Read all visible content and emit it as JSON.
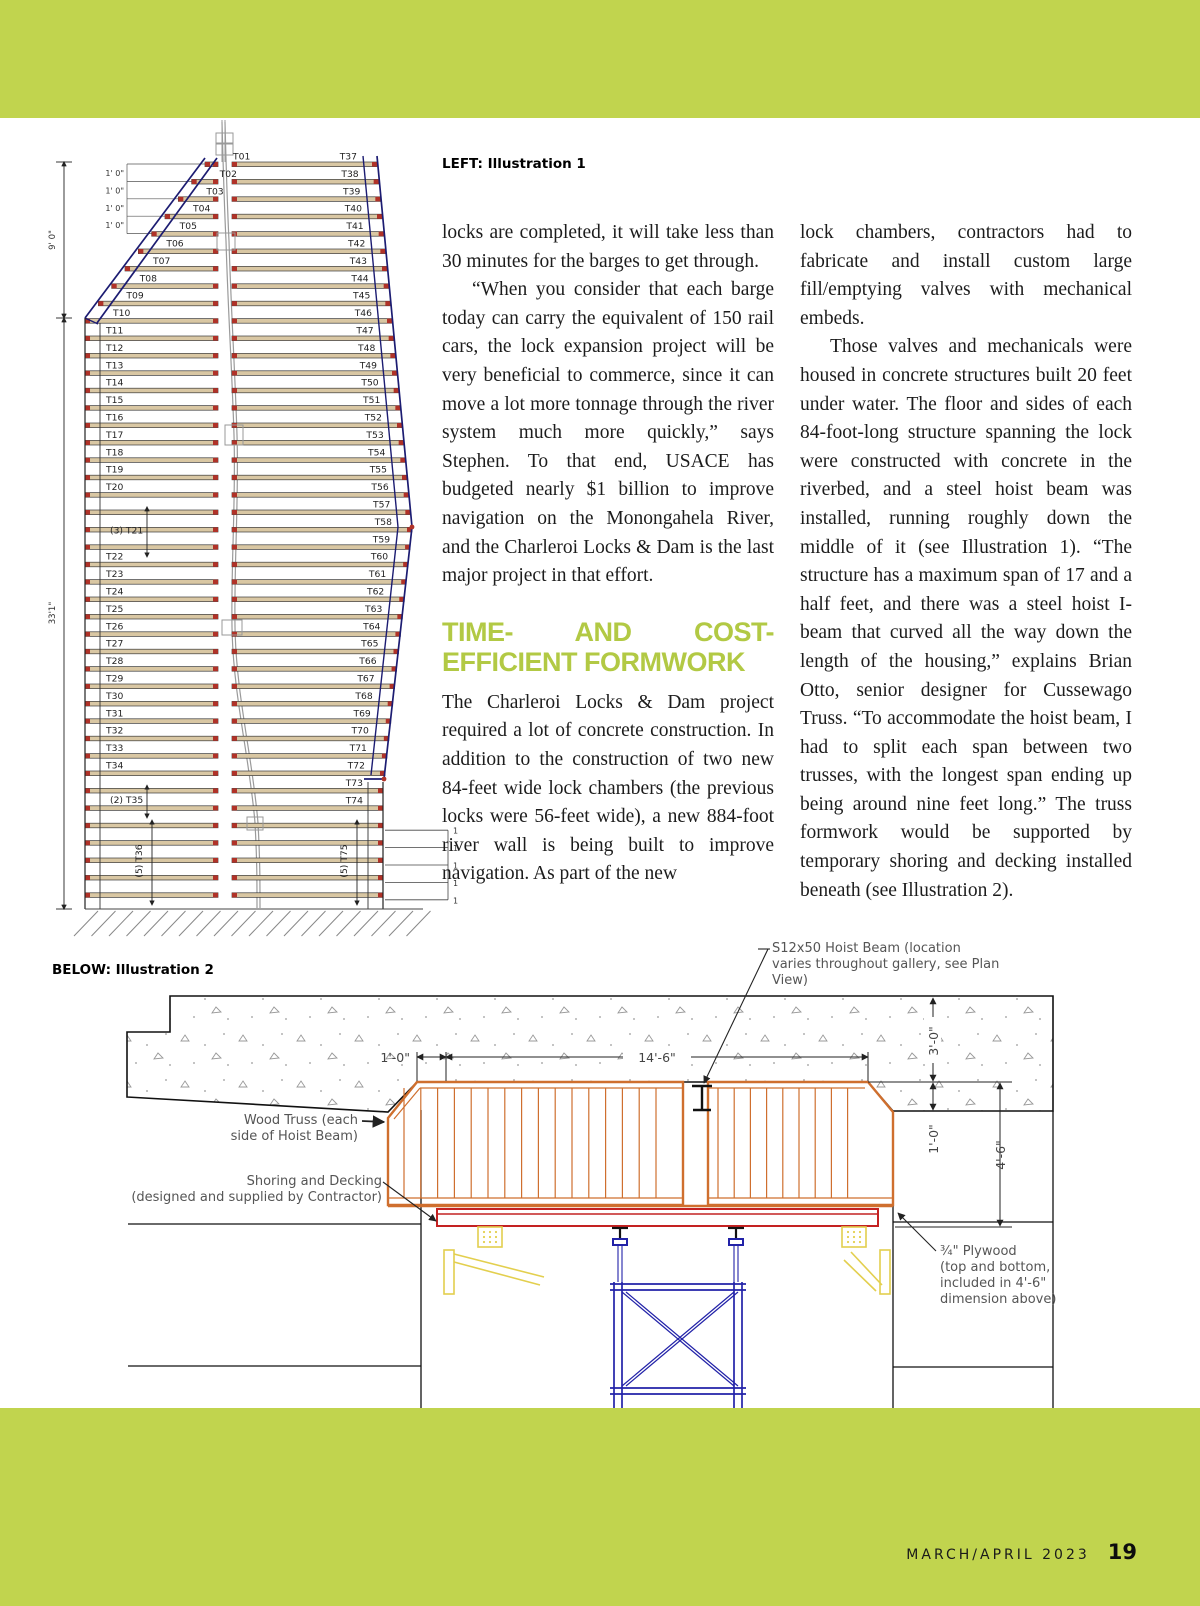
{
  "page": {
    "captions": {
      "illustration1": "LEFT: Illustration 1",
      "illustration2": "BELOW: Illustration 2"
    },
    "footer": {
      "issue": "MARCH/APRIL 2023",
      "page_number": "19"
    }
  },
  "article": {
    "col1": {
      "para1": "locks are completed, it will take less than 30 minutes for the barges to get through.",
      "para2": "“When you consider that each barge today can carry the equivalent of 150 rail cars, the lock expansion project will be very beneficial to commerce, since it can move a lot more tonnage through the river system much more quickly,” says Stephen. To that end, USACE has budgeted nearly $1 billion to improve navigation on the Monongahela River, and the Charleroi Locks & Dam is the last major project in that effort.",
      "heading": "TIME- AND COST-EFFICIENT FORMWORK",
      "para3": "The Charleroi Locks & Dam project required a lot of concrete construction. In addition to the construction of two new 84-feet wide lock chambers (the previous locks were 56-feet wide), a new 884-foot river wall is being built to improve navigation. As part of the new"
    },
    "col2": {
      "para1": "lock chambers, contractors had to fabricate and install custom large fill/emptying valves with mechanical embeds.",
      "para2": "Those valves and mechanicals were housed in concrete structures built 20 feet under water. The floor and sides of each 84-foot-long structure spanning the lock were constructed with concrete in the riverbed, and a steel hoist beam was installed, running roughly down the middle of it (see Illustration 1). “The structure has a maximum span of 17 and a half feet, and there was a steel hoist I-beam that curved all the way down the length of the housing,” explains Brian Otto, senior designer for Cussewago Truss. “To accommodate the hoist beam, I had to split each span between two trusses, with the longest span ending up being around nine feet long.” The truss formwork would be supported by temporary shoring and decking installed beneath (see Illustration 2)."
    }
  },
  "illustration1": {
    "left_column": [
      {
        "label": "T01",
        "bars": 1
      },
      {
        "label": "T02",
        "bars": 1
      },
      {
        "label": "T03",
        "bars": 1
      },
      {
        "label": "T04",
        "bars": 1
      },
      {
        "label": "T05",
        "bars": 1
      },
      {
        "label": "T06",
        "bars": 1
      },
      {
        "label": "T07",
        "bars": 1
      },
      {
        "label": "T08",
        "bars": 1
      },
      {
        "label": "T09",
        "bars": 1
      },
      {
        "label": "T10",
        "bars": 1
      },
      {
        "label": "T11",
        "bars": 1
      },
      {
        "label": "T12",
        "bars": 1
      },
      {
        "label": "T13",
        "bars": 1
      },
      {
        "label": "T14",
        "bars": 1
      },
      {
        "label": "T15",
        "bars": 1
      },
      {
        "label": "T16",
        "bars": 1
      },
      {
        "label": "T17",
        "bars": 1
      },
      {
        "label": "T18",
        "bars": 1
      },
      {
        "label": "T19",
        "bars": 1
      },
      {
        "label": "T20",
        "bars": 1
      },
      {
        "label": "(3) T21",
        "bars": 3,
        "arrow": true
      },
      {
        "label": "T22",
        "bars": 1
      },
      {
        "label": "T23",
        "bars": 1
      },
      {
        "label": "T24",
        "bars": 1
      },
      {
        "label": "T25",
        "bars": 1
      },
      {
        "label": "T26",
        "bars": 1
      },
      {
        "label": "T27",
        "bars": 1
      },
      {
        "label": "T28",
        "bars": 1
      },
      {
        "label": "T29",
        "bars": 1
      },
      {
        "label": "T30",
        "bars": 1
      },
      {
        "label": "T31",
        "bars": 1
      },
      {
        "label": "T32",
        "bars": 1
      },
      {
        "label": "T33",
        "bars": 1
      },
      {
        "label": "T34",
        "bars": 1
      },
      {
        "label": "(2) T35",
        "bars": 2,
        "arrow": true
      },
      {
        "label": "(5) T36",
        "bars": 5,
        "rotated": true
      }
    ],
    "right_column": [
      {
        "label": "T37",
        "bars": 1
      },
      {
        "label": "T38",
        "bars": 1
      },
      {
        "label": "T39",
        "bars": 1
      },
      {
        "label": "T40",
        "bars": 1
      },
      {
        "label": "T41",
        "bars": 1
      },
      {
        "label": "T42",
        "bars": 1
      },
      {
        "label": "T43",
        "bars": 1
      },
      {
        "label": "T44",
        "bars": 1
      },
      {
        "label": "T45",
        "bars": 1
      },
      {
        "label": "T46",
        "bars": 1
      },
      {
        "label": "T47",
        "bars": 1
      },
      {
        "label": "T48",
        "bars": 1
      },
      {
        "label": "T49",
        "bars": 1
      },
      {
        "label": "T50",
        "bars": 1
      },
      {
        "label": "T51",
        "bars": 1
      },
      {
        "label": "T52",
        "bars": 1
      },
      {
        "label": "T53",
        "bars": 1
      },
      {
        "label": "T54",
        "bars": 1
      },
      {
        "label": "T55",
        "bars": 1
      },
      {
        "label": "T56",
        "bars": 1
      },
      {
        "label": "T57",
        "bars": 1
      },
      {
        "label": "T58",
        "bars": 1
      },
      {
        "label": "T59",
        "bars": 1
      },
      {
        "label": "T60",
        "bars": 1
      },
      {
        "label": "T61",
        "bars": 1
      },
      {
        "label": "T62",
        "bars": 1
      },
      {
        "label": "T63",
        "bars": 1
      },
      {
        "label": "T64",
        "bars": 1
      },
      {
        "label": "T65",
        "bars": 1
      },
      {
        "label": "T66",
        "bars": 1
      },
      {
        "label": "T67",
        "bars": 1
      },
      {
        "label": "T68",
        "bars": 1
      },
      {
        "label": "T69",
        "bars": 1
      },
      {
        "label": "T70",
        "bars": 1
      },
      {
        "label": "T71",
        "bars": 1
      },
      {
        "label": "T72",
        "bars": 1
      },
      {
        "label": "T73",
        "bars": 1
      },
      {
        "label": "T74",
        "bars": 1
      },
      {
        "label": "(5) T75",
        "bars": 5,
        "rotated": true
      }
    ],
    "dimensions": {
      "spacing_label": "1' 0\"",
      "upper": "9' 0\"",
      "lower": "33'1\"",
      "right_tick": "1",
      "right_tick_count": 5
    }
  },
  "illustration2": {
    "labels": {
      "hoist_beam_lines": [
        "S12x50 Hoist Beam (location",
        "varies throughout gallery, see Plan",
        "View)"
      ],
      "wood_truss_lines": [
        "Wood Truss (each",
        "side of Hoist Beam)"
      ],
      "shoring_lines": [
        "Shoring and Decking",
        "(designed and supplied by Contractor)"
      ],
      "plywood_lines": [
        "¾\" Plywood",
        "(top and bottom,",
        "included in 4'-6\"",
        "dimension above)"
      ],
      "dims": {
        "offset": "1'-0\"",
        "span": "14'-6\"",
        "depth": "3'-0\"",
        "ledge": "1'-0\"",
        "truss_height": "4'-6\""
      }
    }
  },
  "colors": {
    "band": "#c1d44e",
    "heading": "#b2c944",
    "bar_fill": "#d9c7a3",
    "bar_tip": "#b03228",
    "navy": "#1c1c72",
    "gray": "#9a9a9a",
    "truss": "#cf6f2e",
    "deck": "#c42222",
    "blue": "#2222a8",
    "yellow": "#e3cf4e"
  }
}
